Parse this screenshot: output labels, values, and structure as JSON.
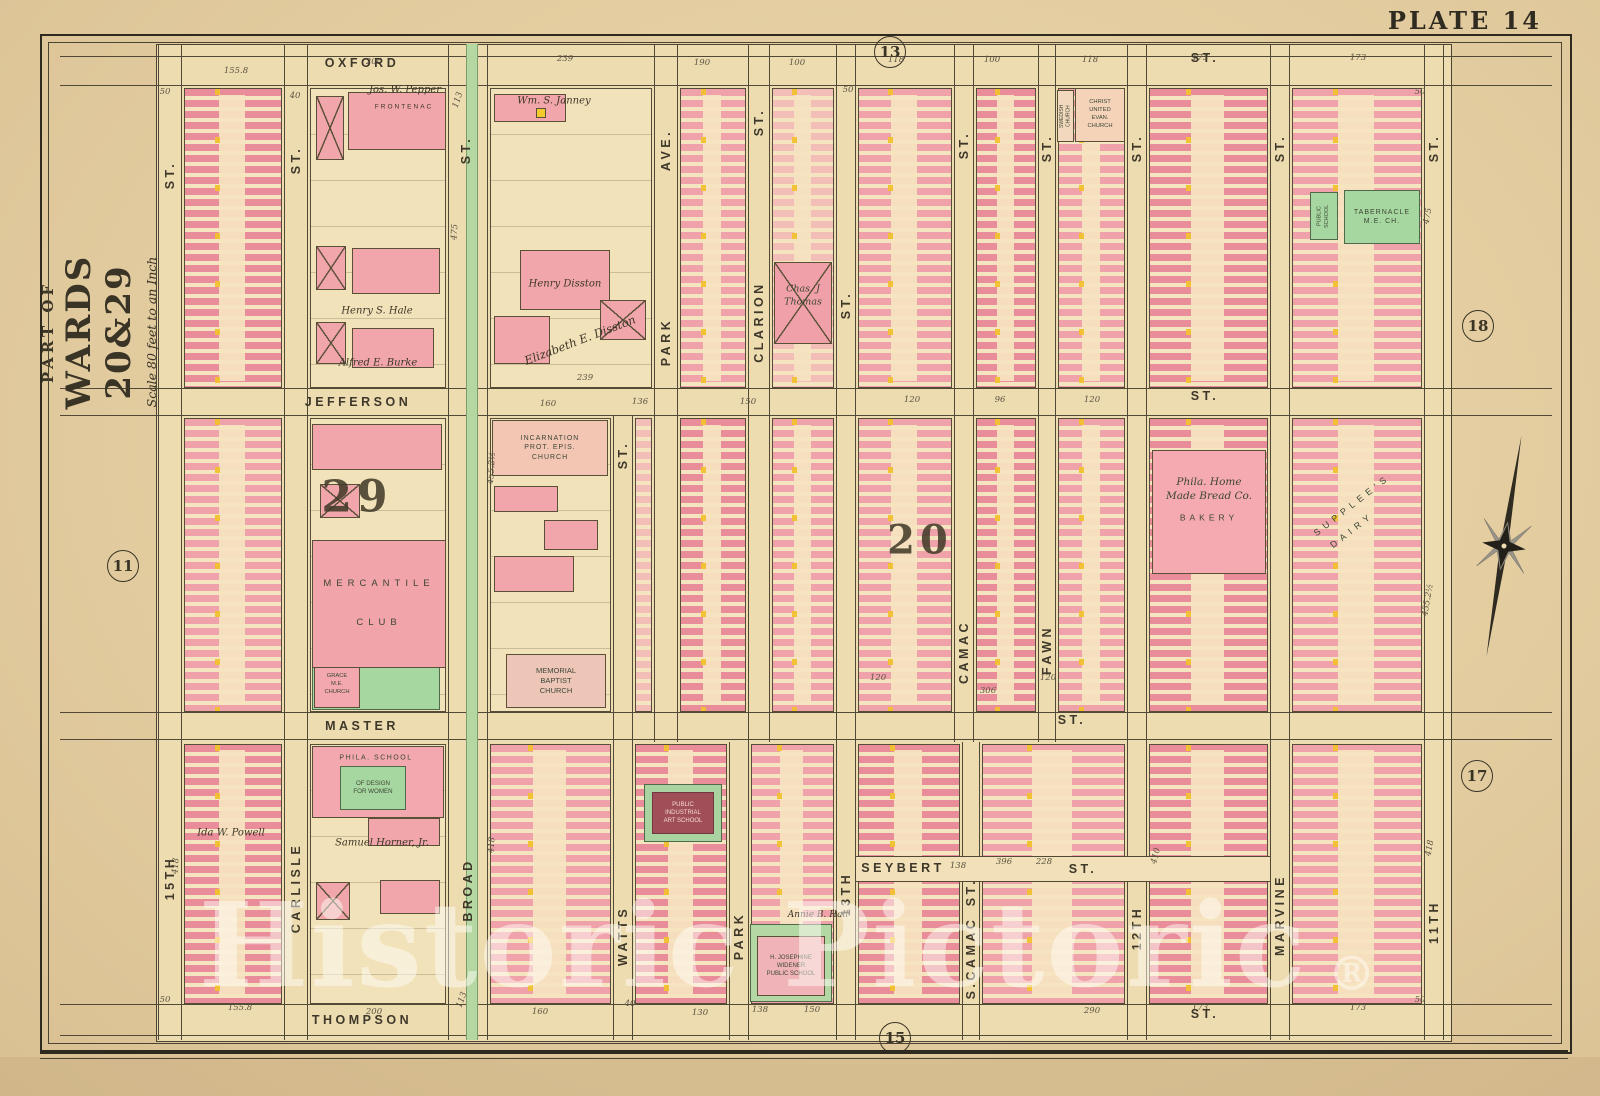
{
  "plate_title": "PLATE 14",
  "margin_title": {
    "line1": "PART OF",
    "line2": "WARDS 20&29",
    "line3": "Scale 80 feet to an Inch"
  },
  "watermark": {
    "text": "Historic Pictoric",
    "mark": "®"
  },
  "colors": {
    "paper": "#e3cda0",
    "content": "#eedcb1",
    "line": "#514935",
    "pink1": "#efa2aa",
    "pink2": "#e98d9b",
    "pink3": "#f3bdb8",
    "yellow": "#f4c92f",
    "green": "#a7d7a0",
    "broad_median": "#b5d8a3",
    "maroon": "#a04f59"
  },
  "plate_refs": [
    {
      "label": "13",
      "x": 890,
      "y": 52
    },
    {
      "label": "11",
      "x": 123,
      "y": 566
    },
    {
      "label": "18",
      "x": 1478,
      "y": 326
    },
    {
      "label": "17",
      "x": 1477,
      "y": 776
    },
    {
      "label": "15",
      "x": 895,
      "y": 1038
    }
  ],
  "wards": [
    {
      "label": "29",
      "x": 357,
      "y": 497
    },
    {
      "label": "20",
      "x": 920,
      "y": 540
    }
  ],
  "streets": {
    "segments": [
      {
        "id": "oxford",
        "o": "h",
        "x": 60,
        "y": 56,
        "w": 1492,
        "h": 30
      },
      {
        "id": "jefferson",
        "o": "h",
        "x": 60,
        "y": 388,
        "w": 1492,
        "h": 28
      },
      {
        "id": "master",
        "o": "h",
        "x": 60,
        "y": 712,
        "w": 1492,
        "h": 28
      },
      {
        "id": "thompson",
        "o": "h",
        "x": 60,
        "y": 1004,
        "w": 1492,
        "h": 32
      },
      {
        "id": "seybert",
        "o": "h",
        "x": 856,
        "y": 856,
        "w": 414,
        "h": 26,
        "fill": true
      },
      {
        "id": "15th",
        "o": "v",
        "x": 158,
        "y": 44,
        "w": 24,
        "h": 996
      },
      {
        "id": "carlisle",
        "o": "v",
        "x": 284,
        "y": 44,
        "w": 24,
        "h": 996
      },
      {
        "id": "broad",
        "o": "v",
        "x": 448,
        "y": 44,
        "w": 40,
        "h": 996
      },
      {
        "id": "watts",
        "o": "v",
        "x": 613,
        "y": 416,
        "w": 20,
        "h": 624
      },
      {
        "id": "park",
        "o": "v",
        "x": 654,
        "y": 44,
        "w": 24,
        "h": 698
      },
      {
        "id": "park-south",
        "o": "v",
        "x": 729,
        "y": 742,
        "w": 20,
        "h": 298
      },
      {
        "id": "clarion",
        "o": "v",
        "x": 748,
        "y": 44,
        "w": 22,
        "h": 698
      },
      {
        "id": "13th",
        "o": "v",
        "x": 836,
        "y": 44,
        "w": 20,
        "h": 996
      },
      {
        "id": "camac",
        "o": "v",
        "x": 954,
        "y": 44,
        "w": 20,
        "h": 698
      },
      {
        "id": "s-camac",
        "o": "v",
        "x": 962,
        "y": 742,
        "w": 18,
        "h": 298
      },
      {
        "id": "fawn",
        "o": "v",
        "x": 1038,
        "y": 44,
        "w": 18,
        "h": 698
      },
      {
        "id": "12th",
        "o": "v",
        "x": 1127,
        "y": 44,
        "w": 20,
        "h": 996
      },
      {
        "id": "marvine",
        "o": "v",
        "x": 1270,
        "y": 44,
        "w": 20,
        "h": 996
      },
      {
        "id": "11th",
        "o": "v",
        "x": 1424,
        "y": 44,
        "w": 20,
        "h": 996
      }
    ],
    "broad_median": {
      "x": 466,
      "y": 44,
      "w": 10,
      "h": 996
    },
    "h_labels": [
      [
        "OXFORD",
        362,
        63
      ],
      [
        "ST.",
        1205,
        58
      ],
      [
        "JEFFERSON",
        358,
        402
      ],
      [
        "ST.",
        1205,
        396
      ],
      [
        "MASTER",
        362,
        726
      ],
      [
        "ST.",
        1072,
        720
      ],
      [
        "SEYBERT",
        903,
        868
      ],
      [
        "ST.",
        1083,
        869
      ],
      [
        "THOMPSON",
        362,
        1020
      ],
      [
        "ST.",
        1205,
        1014
      ]
    ],
    "v_labels": [
      [
        "ST.",
        170,
        175
      ],
      [
        "ST.",
        296,
        160
      ],
      [
        "ST.",
        466,
        150
      ],
      [
        "AVE.",
        666,
        150
      ],
      [
        "PARK",
        666,
        342
      ],
      [
        "ST.",
        759,
        122
      ],
      [
        "CLARION",
        759,
        322
      ],
      [
        "ST.",
        846,
        305
      ],
      [
        "ST.",
        964,
        145
      ],
      [
        "ST.",
        1047,
        148
      ],
      [
        "ST.",
        1137,
        148
      ],
      [
        "ST.",
        1280,
        148
      ],
      [
        "ST.",
        1434,
        148
      ],
      [
        "ST.",
        623,
        455
      ],
      [
        "CAMAC",
        964,
        652
      ],
      [
        "FAWN",
        1047,
        650
      ],
      [
        "15TH",
        170,
        878
      ],
      [
        "CARLISLE",
        296,
        888
      ],
      [
        "BROAD",
        468,
        890
      ],
      [
        "WATTS",
        623,
        936
      ],
      [
        "PARK",
        739,
        936
      ],
      [
        "13TH",
        846,
        894
      ],
      [
        "ST.",
        971,
        892
      ],
      [
        "S.CAMAC",
        971,
        958
      ],
      [
        "12TH",
        1137,
        928
      ],
      [
        "MARVINE",
        1280,
        915
      ],
      [
        "11TH",
        1434,
        922
      ]
    ]
  },
  "blocks": [
    {
      "x": 184,
      "y": 88,
      "w": 98,
      "h": 300,
      "t": "r2"
    },
    {
      "x": 310,
      "y": 88,
      "w": 136,
      "h": 300,
      "t": "e"
    },
    {
      "x": 490,
      "y": 88,
      "w": 162,
      "h": 300,
      "t": "e"
    },
    {
      "x": 680,
      "y": 88,
      "w": 66,
      "h": 300,
      "t": "r1"
    },
    {
      "x": 772,
      "y": 88,
      "w": 62,
      "h": 300,
      "t": "r3"
    },
    {
      "x": 858,
      "y": 88,
      "w": 94,
      "h": 300,
      "t": "r1"
    },
    {
      "x": 976,
      "y": 88,
      "w": 60,
      "h": 300,
      "t": "r2"
    },
    {
      "x": 1058,
      "y": 88,
      "w": 67,
      "h": 300,
      "t": "r1"
    },
    {
      "x": 1149,
      "y": 88,
      "w": 119,
      "h": 300,
      "t": "r2"
    },
    {
      "x": 1292,
      "y": 88,
      "w": 130,
      "h": 300,
      "t": "r1"
    },
    {
      "x": 184,
      "y": 418,
      "w": 98,
      "h": 294,
      "t": "r1"
    },
    {
      "x": 310,
      "y": 418,
      "w": 136,
      "h": 294,
      "t": "e"
    },
    {
      "x": 490,
      "y": 418,
      "w": 121,
      "h": 294,
      "t": "e"
    },
    {
      "x": 635,
      "y": 418,
      "w": 17,
      "h": 294,
      "t": "r3"
    },
    {
      "x": 680,
      "y": 418,
      "w": 66,
      "h": 294,
      "t": "r2"
    },
    {
      "x": 772,
      "y": 418,
      "w": 62,
      "h": 294,
      "t": "r1"
    },
    {
      "x": 858,
      "y": 418,
      "w": 94,
      "h": 294,
      "t": "r1"
    },
    {
      "x": 976,
      "y": 418,
      "w": 60,
      "h": 294,
      "t": "r2"
    },
    {
      "x": 1058,
      "y": 418,
      "w": 67,
      "h": 294,
      "t": "r1"
    },
    {
      "x": 1149,
      "y": 418,
      "w": 119,
      "h": 294,
      "t": "r2"
    },
    {
      "x": 1292,
      "y": 418,
      "w": 130,
      "h": 294,
      "t": "r1"
    },
    {
      "x": 184,
      "y": 744,
      "w": 98,
      "h": 260,
      "t": "r2"
    },
    {
      "x": 310,
      "y": 744,
      "w": 136,
      "h": 260,
      "t": "e"
    },
    {
      "x": 490,
      "y": 744,
      "w": 121,
      "h": 260,
      "t": "r1"
    },
    {
      "x": 635,
      "y": 744,
      "w": 92,
      "h": 260,
      "t": "r2"
    },
    {
      "x": 751,
      "y": 744,
      "w": 83,
      "h": 260,
      "t": "r1"
    },
    {
      "x": 858,
      "y": 744,
      "w": 102,
      "h": 260,
      "t": "r2"
    },
    {
      "x": 982,
      "y": 744,
      "w": 143,
      "h": 260,
      "t": "r1"
    },
    {
      "x": 1149,
      "y": 744,
      "w": 119,
      "h": 260,
      "t": "r2"
    },
    {
      "x": 1292,
      "y": 744,
      "w": 130,
      "h": 260,
      "t": "r1"
    }
  ],
  "parcels": [
    {
      "x": 348,
      "y": 92,
      "w": 98,
      "h": 58
    },
    {
      "x": 316,
      "y": 96,
      "w": 28,
      "h": 64,
      "xm": true
    },
    {
      "x": 352,
      "y": 248,
      "w": 88,
      "h": 46
    },
    {
      "x": 316,
      "y": 246,
      "w": 30,
      "h": 44,
      "xm": true
    },
    {
      "x": 352,
      "y": 328,
      "w": 82,
      "h": 40
    },
    {
      "x": 316,
      "y": 322,
      "w": 30,
      "h": 42,
      "xm": true
    },
    {
      "x": 494,
      "y": 94,
      "w": 72,
      "h": 28
    },
    {
      "x": 536,
      "y": 108,
      "w": 10,
      "h": 10,
      "yel": true
    },
    {
      "x": 520,
      "y": 250,
      "w": 90,
      "h": 60
    },
    {
      "x": 494,
      "y": 316,
      "w": 56,
      "h": 48
    },
    {
      "x": 600,
      "y": 300,
      "w": 46,
      "h": 40,
      "xm": true
    },
    {
      "x": 312,
      "y": 424,
      "w": 130,
      "h": 46
    },
    {
      "x": 320,
      "y": 484,
      "w": 40,
      "h": 34,
      "xm": true
    },
    {
      "x": 330,
      "y": 560,
      "w": 16,
      "h": 40,
      "yel": true
    },
    {
      "x": 494,
      "y": 486,
      "w": 64,
      "h": 26
    },
    {
      "x": 544,
      "y": 520,
      "w": 54,
      "h": 30
    },
    {
      "x": 494,
      "y": 556,
      "w": 80,
      "h": 36
    },
    {
      "x": 368,
      "y": 818,
      "w": 72,
      "h": 28
    },
    {
      "x": 316,
      "y": 882,
      "w": 34,
      "h": 38,
      "xm": true
    },
    {
      "x": 380,
      "y": 880,
      "w": 60,
      "h": 34
    }
  ],
  "landmarks": [
    {
      "id": "public-school",
      "x": 1310,
      "y": 192,
      "w": 28,
      "h": 48,
      "bg": "#a7d7a0",
      "bd": "#50694b",
      "fs": 5.5,
      "vert": true,
      "lines": [
        "PUBLIC",
        "SCHOOL"
      ]
    },
    {
      "id": "tabernacle-me-church",
      "x": 1344,
      "y": 190,
      "w": 76,
      "h": 54,
      "bg": "#a7d7a0",
      "bd": "#50694b",
      "fs": 7,
      "ls": 1,
      "lines": [
        "TABERNACLE",
        "M.E. CH."
      ]
    },
    {
      "id": "grace-church-grounds",
      "x": 312,
      "y": 660,
      "w": 128,
      "h": 50,
      "bg": "#a7d7a0",
      "bd": "#50694b",
      "lines": []
    },
    {
      "id": "grace-me-church",
      "x": 314,
      "y": 662,
      "w": 46,
      "h": 46,
      "bg": "#f2a8ae",
      "bd": "#5a4f37",
      "fs": 5.8,
      "lines": [
        "GRACE",
        "M.E.",
        "CHURCH"
      ]
    },
    {
      "id": "design-school-building",
      "x": 312,
      "y": 746,
      "w": 132,
      "h": 72,
      "bg": "#f2a8ae",
      "bd": "#5a4f37",
      "lines": []
    },
    {
      "id": "phila-school-label",
      "x": 376,
      "y": 758,
      "fs": 7,
      "ls": 1.5,
      "pt": true,
      "lines": [
        "PHILA. SCHOOL"
      ]
    },
    {
      "id": "design-school-green",
      "x": 340,
      "y": 766,
      "w": 66,
      "h": 44,
      "bg": "#a7d7a0",
      "bd": "#50694b",
      "fs": 6.2,
      "lines": [
        "OF DESIGN",
        "FOR WOMEN"
      ]
    },
    {
      "id": "industrial-school-grounds",
      "x": 644,
      "y": 784,
      "w": 78,
      "h": 58,
      "bg": "#a9d3a0",
      "bd": "#50694b",
      "lines": []
    },
    {
      "id": "public-industrial-art-school",
      "x": 652,
      "y": 792,
      "w": 62,
      "h": 42,
      "bg": "#a04f59",
      "bd": "#713741",
      "color": "#f6dccd",
      "fs": 6,
      "lines": [
        "PUBLIC",
        "INDUSTRIAL",
        "ART SCHOOL"
      ]
    },
    {
      "id": "widener-school-grounds",
      "x": 750,
      "y": 924,
      "w": 82,
      "h": 78,
      "bg": "#b3d8a4",
      "bd": "#50694b",
      "lines": []
    },
    {
      "id": "widener-public-school",
      "x": 757,
      "y": 936,
      "w": 68,
      "h": 60,
      "bg": "#f0b4b8",
      "bd": "#5a4f37",
      "fs": 6,
      "lines": [
        "H. JOSEPHINE",
        "WIDENER",
        "PUBLIC SCHOOL"
      ]
    },
    {
      "id": "christ-united-evan-church",
      "x": 1075,
      "y": 88,
      "w": 50,
      "h": 54,
      "bg": "#f4d3b9",
      "bd": "#5a4f37",
      "fs": 5.8,
      "lines": [
        "CHRIST",
        "UNITED",
        "EVAN.",
        "CHURCH"
      ]
    },
    {
      "id": "swedish-church",
      "x": 1057,
      "y": 90,
      "w": 17,
      "h": 52,
      "bg": "#f2d9bd",
      "bd": "#5a4f37",
      "fs": 5,
      "vert": true,
      "lines": [
        "SWEDISH",
        "CHURCH"
      ]
    },
    {
      "id": "incarnation-church",
      "x": 492,
      "y": 420,
      "w": 116,
      "h": 56,
      "bg": "#f3c6b4",
      "bd": "#5a4f37",
      "fs": 7,
      "ls": 1,
      "lines": [
        "INCARNATION",
        "PROT. EPIS.",
        "CHURCH"
      ]
    },
    {
      "id": "mercantile-club",
      "x": 312,
      "y": 540,
      "w": 134,
      "h": 128,
      "bg": "#f2a4ab",
      "bd": "#5a4f37",
      "fs": 9.5,
      "ls": 5,
      "gap": 26,
      "lines": [
        "MERCANTILE",
        "CLUB"
      ]
    },
    {
      "id": "memorial-baptist-church",
      "x": 506,
      "y": 654,
      "w": 100,
      "h": 54,
      "bg": "#eec6b8",
      "bd": "#5a4f37",
      "fs": 7.5,
      "lines": [
        "MEMORIAL",
        "BAPTIST",
        "CHURCH"
      ]
    },
    {
      "id": "bakery-building",
      "x": 1152,
      "y": 450,
      "w": 114,
      "h": 124,
      "bg": "#f4aab0",
      "bd": "#5a4f37",
      "lines": []
    },
    {
      "id": "bakery-name-1",
      "x": 1209,
      "y": 482,
      "fs": 10.5,
      "it": true,
      "sf": true,
      "pt": true,
      "lines": [
        "Phila. Home"
      ]
    },
    {
      "id": "bakery-name-2",
      "x": 1209,
      "y": 496,
      "fs": 10.5,
      "it": true,
      "sf": true,
      "pt": true,
      "lines": [
        "Made Bread Co."
      ]
    },
    {
      "id": "bakery-label",
      "x": 1209,
      "y": 518,
      "fs": 8.5,
      "ls": 4,
      "pt": true,
      "lines": [
        "BAKERY"
      ]
    },
    {
      "id": "thomas-parcel",
      "x": 774,
      "y": 262,
      "w": 58,
      "h": 82,
      "bg": "#f0a0a8",
      "bd": "#5a4f37",
      "xmark": true,
      "lines": []
    },
    {
      "id": "chas-thomas-1",
      "x": 803,
      "y": 290,
      "fs": 9.5,
      "it": true,
      "sf": true,
      "pt": true,
      "lines": [
        "Chas. J"
      ]
    },
    {
      "id": "chas-thomas-2",
      "x": 803,
      "y": 303,
      "fs": 9.5,
      "it": true,
      "sf": true,
      "pt": true,
      "lines": [
        "Thomas"
      ]
    },
    {
      "id": "supplees-label",
      "x": 1352,
      "y": 505,
      "fs": 9,
      "ls": 5,
      "rot": -38,
      "pt": true,
      "lines": [
        "SUPPLEE'S"
      ]
    },
    {
      "id": "dairy-label",
      "x": 1352,
      "y": 530,
      "fs": 9,
      "ls": 5,
      "rot": -38,
      "pt": true,
      "lines": [
        "DAIRY"
      ]
    }
  ],
  "names": [
    {
      "t": "Jos. W. Pepper",
      "x": 405,
      "y": 90
    },
    {
      "t": "FRONTENAC",
      "x": 404,
      "y": 107,
      "caps": true,
      "fs": 6.5,
      "ls": 2
    },
    {
      "t": "Wm. S. Janney",
      "x": 554,
      "y": 101
    },
    {
      "t": "Henry Disston",
      "x": 565,
      "y": 284
    },
    {
      "t": "Elizabeth E. Disston",
      "x": 580,
      "y": 340,
      "rot": -21,
      "fs": 11.5
    },
    {
      "t": "Henry S. Hale",
      "x": 377,
      "y": 311
    },
    {
      "t": "Alfred E. Burke",
      "x": 378,
      "y": 363
    },
    {
      "t": "Ida W. Powell",
      "x": 231,
      "y": 833
    },
    {
      "t": "Samuel Horner, Jr.",
      "x": 382,
      "y": 843
    },
    {
      "t": "Annie B. Hall",
      "x": 818,
      "y": 915,
      "fs": 9
    }
  ],
  "dims": [
    [
      "155.8",
      236,
      71
    ],
    [
      "200",
      374,
      62
    ],
    [
      "239",
      565,
      59
    ],
    [
      "190",
      702,
      63
    ],
    [
      "100",
      797,
      63
    ],
    [
      "118",
      896,
      60
    ],
    [
      "100",
      992,
      60
    ],
    [
      "118",
      1090,
      60
    ],
    [
      "173",
      1200,
      58
    ],
    [
      "173",
      1358,
      58
    ],
    [
      "50",
      165,
      92
    ],
    [
      "40",
      295,
      96
    ],
    [
      "50",
      848,
      90
    ],
    [
      "50",
      1420,
      92
    ],
    [
      "113",
      458,
      100,
      -72
    ],
    [
      "475",
      455,
      232,
      -86
    ],
    [
      "475",
      1428,
      216,
      -80
    ],
    [
      "239",
      585,
      378,
      0
    ],
    [
      "455.2½",
      492,
      468,
      -86
    ],
    [
      "455.2½",
      1428,
      600,
      -80
    ],
    [
      "418",
      492,
      845,
      -86
    ],
    [
      "418",
      1430,
      848,
      -80
    ],
    [
      "418",
      176,
      866,
      -86
    ],
    [
      "160",
      548,
      404
    ],
    [
      "136",
      640,
      402
    ],
    [
      "150",
      748,
      402
    ],
    [
      "120",
      912,
      400
    ],
    [
      "96",
      1000,
      400
    ],
    [
      "120",
      1092,
      400
    ],
    [
      "120",
      878,
      678
    ],
    [
      "306",
      988,
      691
    ],
    [
      "120",
      1048,
      678
    ],
    [
      "396",
      1004,
      862
    ],
    [
      "138",
      958,
      866
    ],
    [
      "228",
      1044,
      862
    ],
    [
      "410",
      1156,
      856,
      -75
    ],
    [
      "155.8",
      240,
      1008
    ],
    [
      "200",
      374,
      1012
    ],
    [
      "113",
      462,
      1000,
      -70
    ],
    [
      "160",
      540,
      1012
    ],
    [
      "130",
      700,
      1013
    ],
    [
      "138",
      760,
      1010
    ],
    [
      "150",
      812,
      1010
    ],
    [
      "290",
      1092,
      1011
    ],
    [
      "173",
      1200,
      1008
    ],
    [
      "173",
      1358,
      1008
    ],
    [
      "50",
      165,
      1000
    ],
    [
      "40",
      630,
      1004
    ],
    [
      "50",
      1420,
      1000
    ]
  ]
}
